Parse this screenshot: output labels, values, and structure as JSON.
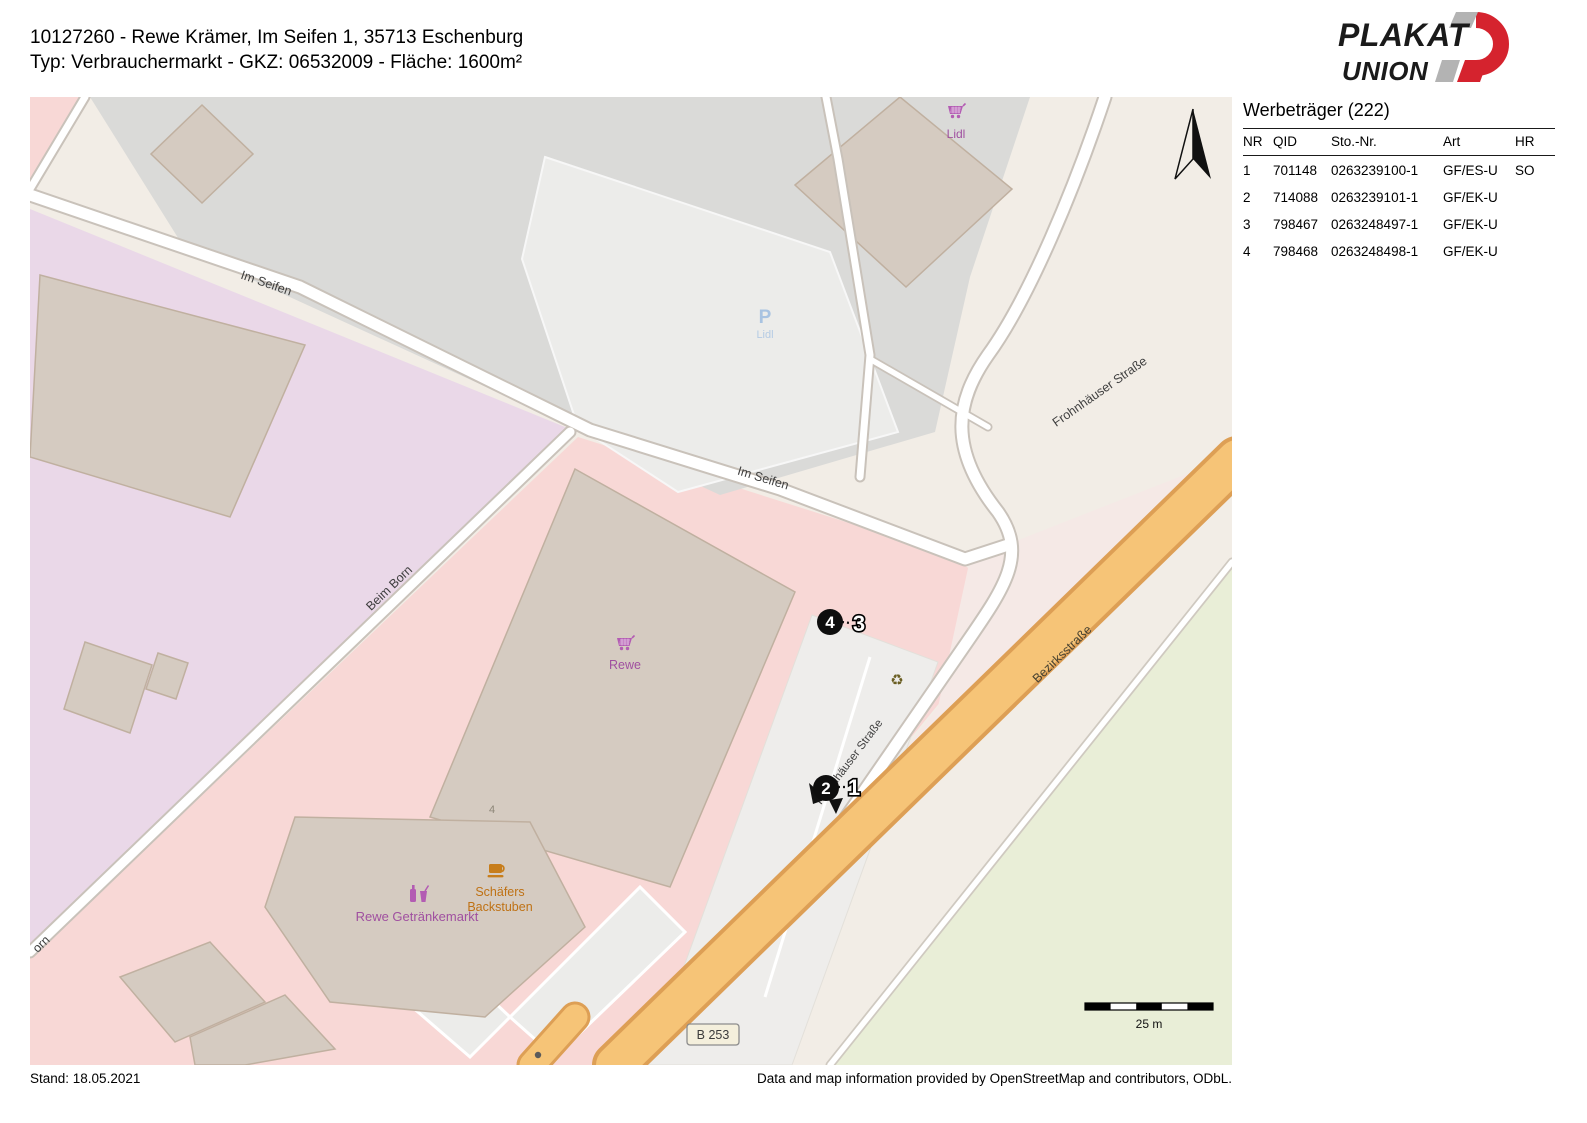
{
  "header": {
    "title_line1": "10127260 - Rewe Krämer, Im Seifen 1, 35713 Eschenburg",
    "title_line2": "Typ: Verbrauchermarkt - GKZ: 06532009 - Fläche: 1600m²"
  },
  "logo": {
    "word1": "PLAKAT",
    "word2": "UNION"
  },
  "panel": {
    "title": "Werbeträger (222)",
    "columns": {
      "nr": "NR",
      "qid": "QID",
      "sto": "Sto.-Nr.",
      "art": "Art",
      "hr": "HR"
    },
    "rows": [
      {
        "nr": "1",
        "qid": "701148",
        "sto": "0263239100-1",
        "art": "GF/ES-U",
        "hr": "SO"
      },
      {
        "nr": "2",
        "qid": "714088",
        "sto": "0263239101-1",
        "art": "GF/EK-U",
        "hr": ""
      },
      {
        "nr": "3",
        "qid": "798467",
        "sto": "0263248497-1",
        "art": "GF/EK-U",
        "hr": ""
      },
      {
        "nr": "4",
        "qid": "798468",
        "sto": "0263248498-1",
        "art": "GF/EK-U",
        "hr": ""
      }
    ]
  },
  "map": {
    "labels": {
      "im_seifen_a": "Im Seifen",
      "im_seifen_b": "Im Seifen",
      "beim_born": "Beim Born",
      "born_partial": "orn",
      "frohnhauser_a": "Frohnhäuser Straße",
      "frohnhauser_b": "Frohnhäuser Straße",
      "bezirksstrasse": "Bezirksstraße",
      "b253": "B 253",
      "parking_p": "P",
      "parking_name": "Lidl",
      "lidl_poi": "Lidl",
      "rewe_poi": "Rewe",
      "getraenkemarkt_poi": "Rewe Getränkemarkt",
      "schaefers_line1": "Schäfers",
      "schaefers_line2": "Backstuben",
      "house_number": "4",
      "recycle_glyph": "♻"
    },
    "markers": [
      {
        "nr": "4",
        "style": "filled"
      },
      {
        "nr": "3",
        "style": "outline"
      },
      {
        "nr": "2",
        "style": "filled"
      },
      {
        "nr": "1",
        "style": "outline"
      }
    ],
    "scale_label": "25 m"
  },
  "footer": {
    "stand": "Stand: 18.05.2021",
    "attribution": "Data and map information provided by OpenStreetMap and contributors, ODbL."
  },
  "colors": {
    "accent_red": "#d5232e",
    "retail_pink": "#f8d8d6",
    "industrial_purple": "#ead8e8",
    "road_orange": "#f6c477",
    "grass_green": "#e9eed7",
    "poi_purple": "#a050a0",
    "poi_orange": "#bf7215",
    "parking_blue": "#a9c3e1"
  }
}
